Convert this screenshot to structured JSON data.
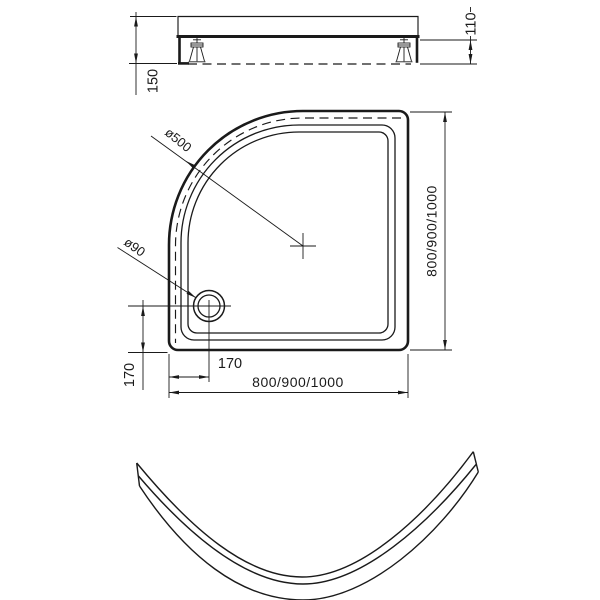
{
  "colors": {
    "line": "#1a1a1a",
    "background": "#ffffff"
  },
  "side_view": {
    "total_height": "150",
    "clearance_height": "110"
  },
  "plan_view": {
    "corner_diameter": "ø500",
    "drain_diameter": "ø90",
    "drain_offset_bottom": "170",
    "drain_offset_side": "170",
    "width_options": "800/900/1000",
    "depth_options": "800/900/1000"
  }
}
